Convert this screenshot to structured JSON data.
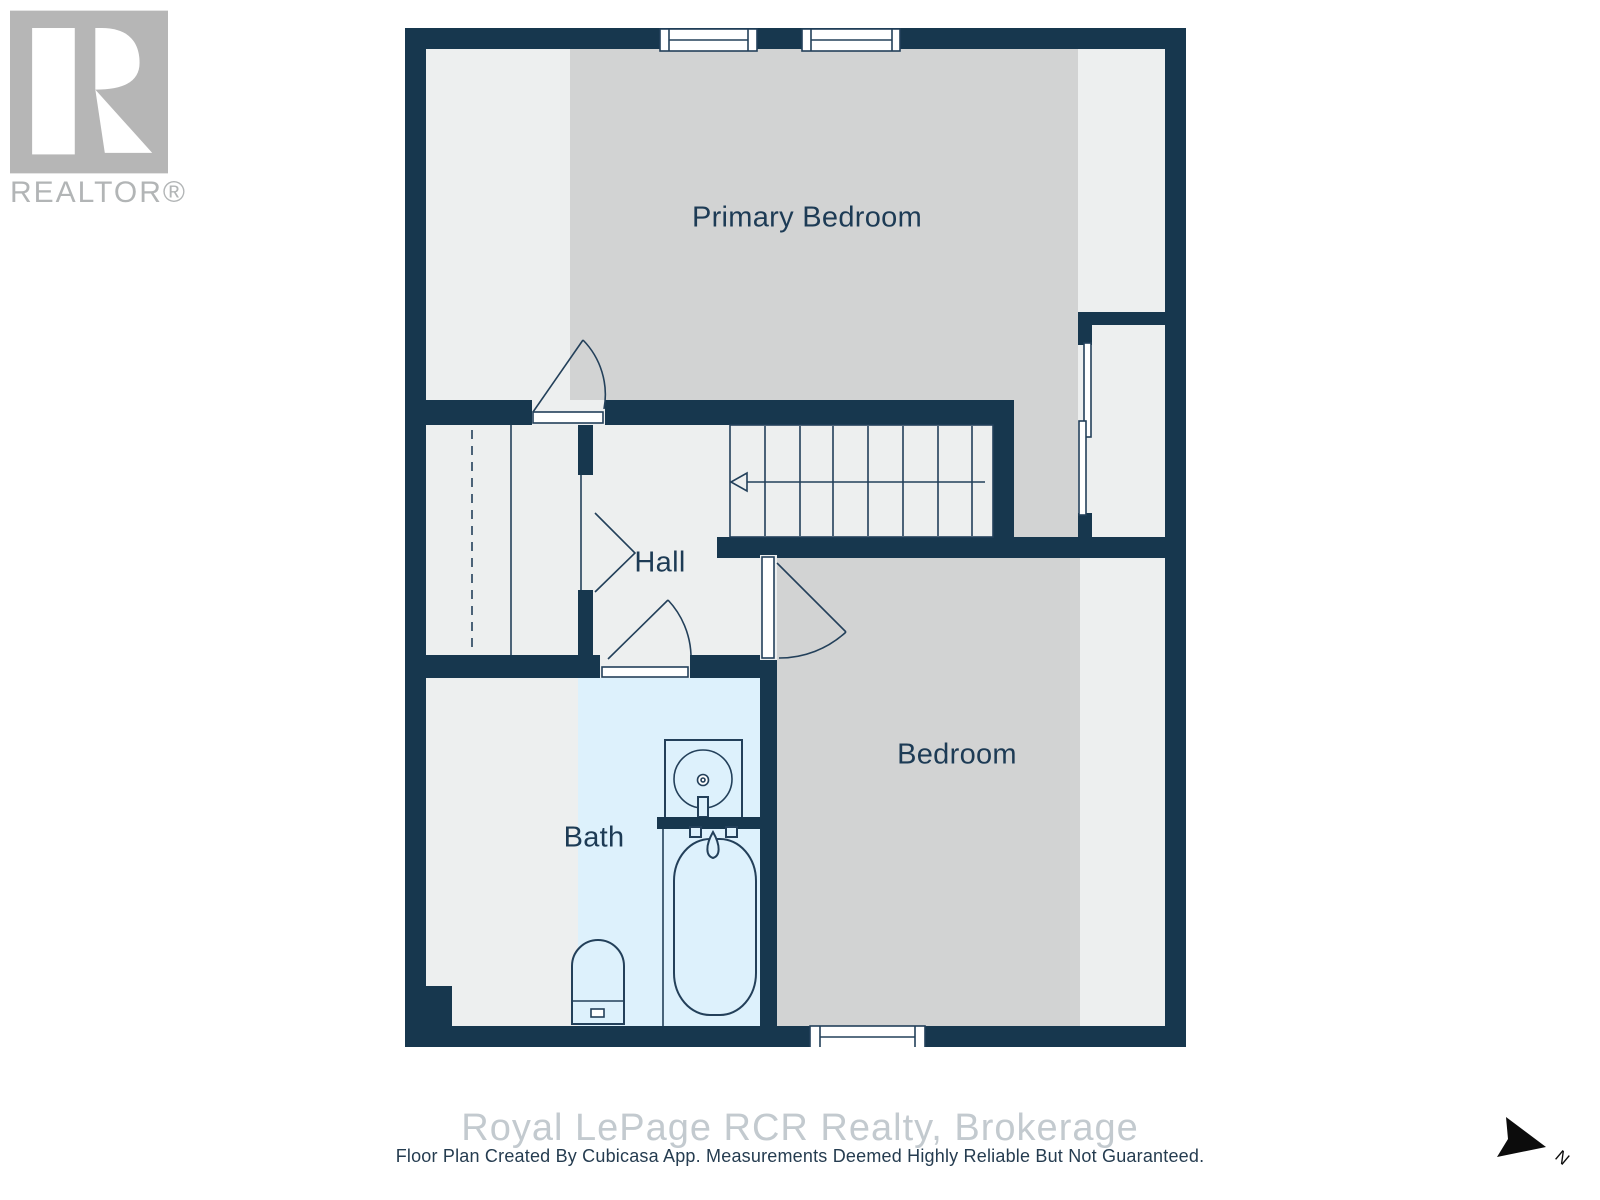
{
  "branding": {
    "logo_text": "REALTOR®"
  },
  "floorplan": {
    "rooms": [
      {
        "id": "primary-bedroom",
        "label": "Primary Bedroom"
      },
      {
        "id": "hall",
        "label": "Hall"
      },
      {
        "id": "bath",
        "label": "Bath"
      },
      {
        "id": "bedroom",
        "label": "Bedroom"
      }
    ],
    "compass": {
      "north_label": "N"
    }
  },
  "footer": {
    "watermark": "Royal LePage RCR Realty, Brokerage",
    "disclaimer": "Floor Plan Created By Cubicasa App. Measurements Deemed Highly Reliable But Not Guaranteed."
  },
  "colors": {
    "wall": "#17374e",
    "floor": "#edefef",
    "carpet": "#d2d3d3",
    "bath_floor": "#ddf1fc",
    "line": "#23405a",
    "label_text": "#1d3b55",
    "logo_gray": "#b6b6b6",
    "watermark_text": "#c3cacf",
    "disclaimer_text": "#253c50"
  }
}
